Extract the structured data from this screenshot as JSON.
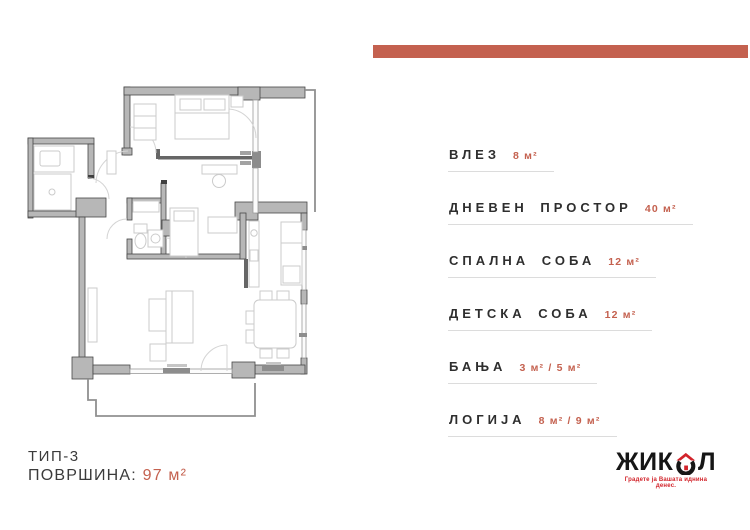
{
  "colors": {
    "accent": "#c4614f",
    "logo_red": "#d2232a",
    "room_text": "#2e2e2e",
    "wall_gray": "#b7b7b7",
    "underline_gray": "#dcdcdc"
  },
  "rooms": [
    {
      "name": "ВЛЕЗ",
      "area": "8 м²"
    },
    {
      "name": "ДНЕВЕН ПРОСТОР",
      "area": "40 м²"
    },
    {
      "name": "СПАЛНА СОБА",
      "area": "12 м²"
    },
    {
      "name": "ДЕТСКА СОБА",
      "area": "12 м²"
    },
    {
      "name": "БАЊА",
      "area": "3 м² / 5 м²"
    },
    {
      "name": "ЛОГИЈА",
      "area": "8 м² / 9 м²"
    }
  ],
  "footer": {
    "type_label": "ТИП-3",
    "area_label": "ПОВРШИНА:",
    "area_value": "97 м²"
  },
  "logo": {
    "brand_prefix": "ЖИК",
    "brand_suffix": "Л",
    "tagline": "Градете ја Вашата иднина денес.",
    "icons": {
      "logo_house_icon": "⌂"
    }
  }
}
